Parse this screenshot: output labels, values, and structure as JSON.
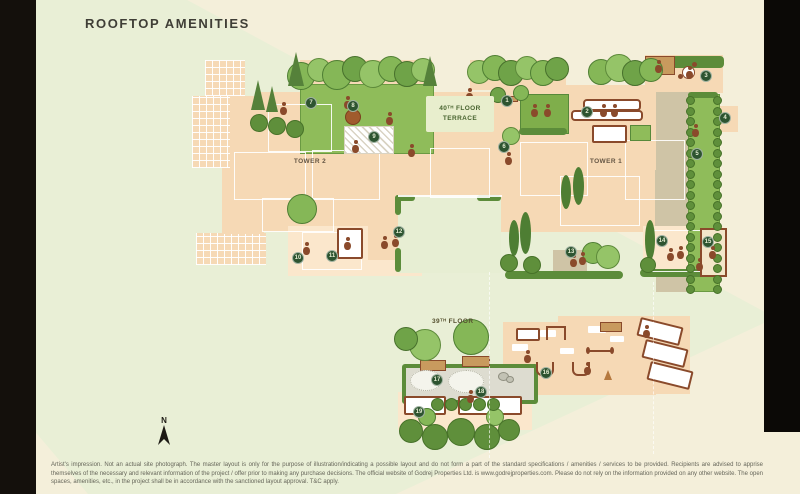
{
  "header": {
    "title": "ROOFTOP AMENITIES"
  },
  "plan": {
    "tower1_label": "TOWER 1",
    "tower2_label": "TOWER 2",
    "terrace_label": {
      "line1": "40ᵀᴴ FLOOR",
      "line2": "TERRACE"
    },
    "floor39_label": "39ᵀᴴ FLOOR"
  },
  "compass": {
    "label": "N"
  },
  "markers": [
    {
      "number": "1",
      "x": 506,
      "y": 100
    },
    {
      "number": "2",
      "x": 586,
      "y": 111
    },
    {
      "number": "3",
      "x": 705,
      "y": 75
    },
    {
      "number": "4",
      "x": 724,
      "y": 117
    },
    {
      "number": "5",
      "x": 696,
      "y": 153
    },
    {
      "number": "6",
      "x": 503,
      "y": 146
    },
    {
      "number": "7",
      "x": 310,
      "y": 102
    },
    {
      "number": "8",
      "x": 352,
      "y": 105
    },
    {
      "number": "9",
      "x": 373,
      "y": 136
    },
    {
      "number": "10",
      "x": 297,
      "y": 257
    },
    {
      "number": "11",
      "x": 331,
      "y": 255
    },
    {
      "number": "12",
      "x": 398,
      "y": 231
    },
    {
      "number": "13",
      "x": 570,
      "y": 251
    },
    {
      "number": "14",
      "x": 661,
      "y": 240
    },
    {
      "number": "15",
      "x": 707,
      "y": 241
    },
    {
      "number": "16",
      "x": 545,
      "y": 372
    },
    {
      "number": "17",
      "x": 436,
      "y": 379
    },
    {
      "number": "18",
      "x": 480,
      "y": 391
    },
    {
      "number": "19",
      "x": 418,
      "y": 411
    }
  ],
  "footer": {
    "disclaimer": "Artist's impression. Not an actual site photograph. The master layout is only for the purpose of illustration/indicating a possible layout and do not form a part of the standard specifications / amenities / services to be provided. Recipients are advised to apprise themselves of the necessary and relevant information of the project / offer prior to making any purchase decisions. The official website of Godrej Properties Ltd. is www.godrejproperties.com. Please do not rely on the information provided on any other website. The open spaces, amenities, etc., in the project shall be in accordance with the sanctioned layout approval. T&C apply."
  },
  "colors": {
    "background": "#e9efd6",
    "background_accent": "#f4efda",
    "deck": "#f6d9b5",
    "lawn": "#8fbc5a",
    "hedge": "#5c8c3a",
    "marker": "#2d5430",
    "title_text": "#3f3e36"
  }
}
